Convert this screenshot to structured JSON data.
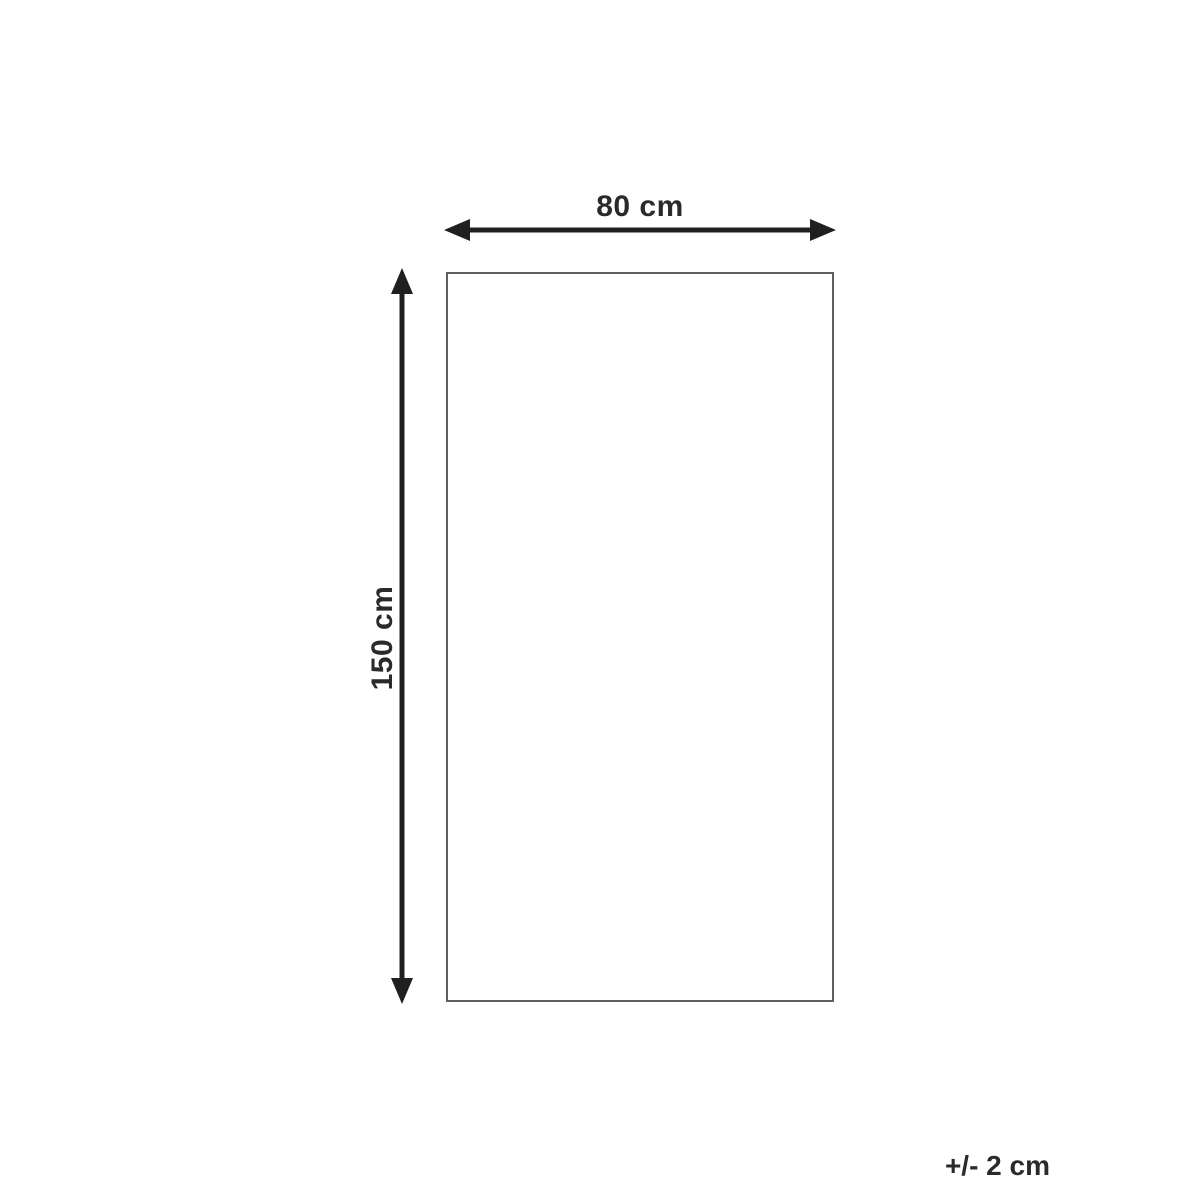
{
  "diagram": {
    "width_label": "80 cm",
    "height_label": "150 cm",
    "tolerance_label": "+/- 2 cm",
    "colors": {
      "arrow": "#1f1f1f",
      "rect_border": "#5f5f5f",
      "text": "#2a2a2a",
      "background": "#ffffff"
    }
  }
}
